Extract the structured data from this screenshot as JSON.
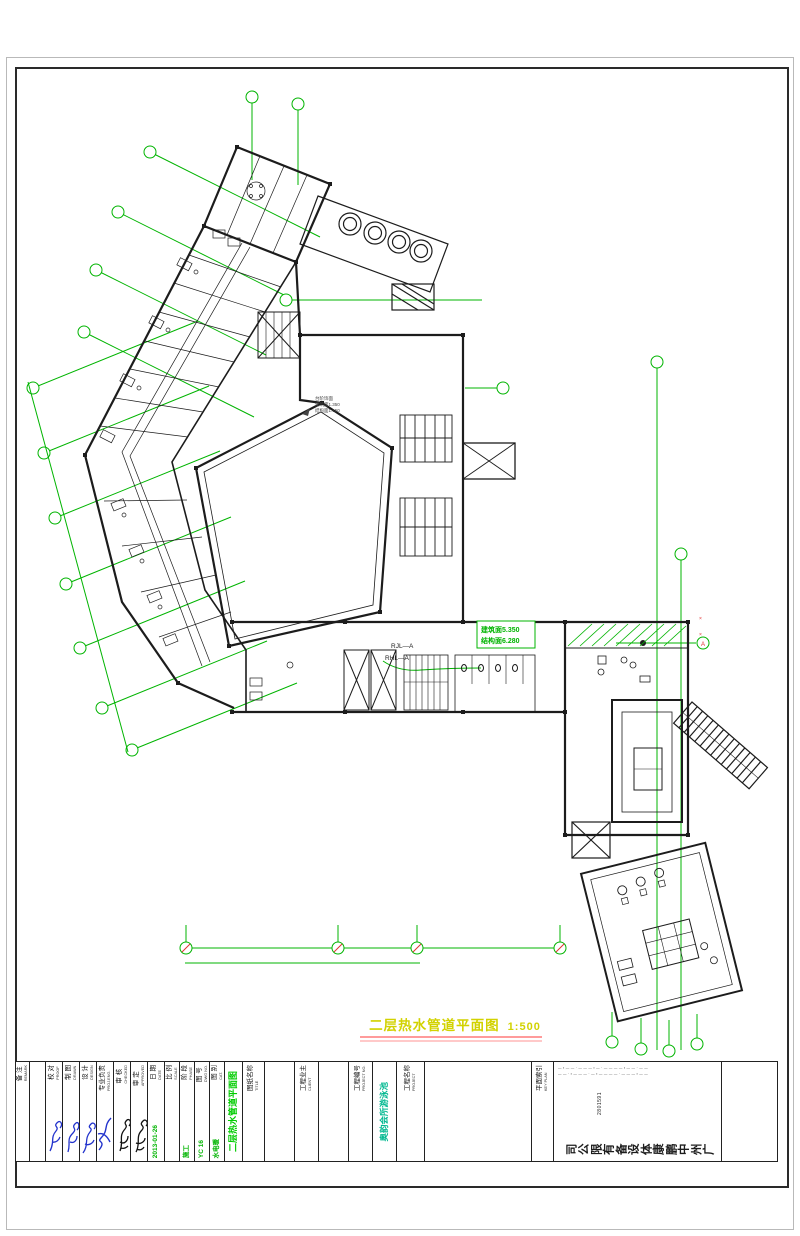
{
  "sheet": {
    "plan_title": "二层热水管道平面图",
    "plan_scale": "1:500"
  },
  "plan": {
    "riser1": "RJL—A",
    "riser2": "RHL—A",
    "elev_line1": "建筑面5.350",
    "elev_line2": "结构面6.280",
    "note1": "台阶饰面",
    "note2": "建筑面1.350",
    "note3": "结构面1.150",
    "axis_bubble_label": "A",
    "red_mark": "×"
  },
  "title_block": {
    "remark": {
      "cn": "备 注",
      "en": "REMARK"
    },
    "proof": {
      "cn": "校 对",
      "en": "PROOF"
    },
    "drawn": {
      "cn": "制 图",
      "en": "DRAWN"
    },
    "design": {
      "cn": "设 计",
      "en": "DESIGN"
    },
    "proj_eng": {
      "cn": "专业负责",
      "en": "PROJ.ENG."
    },
    "checked": {
      "cn": "审 核",
      "en": "CHECKED"
    },
    "approved": {
      "cn": "审 定",
      "en": "APPROVED"
    },
    "date": {
      "cn": "日 期",
      "en": "DATE",
      "value": "2013-01-26"
    },
    "scale": {
      "cn": "比 例",
      "en": "SCALE",
      "value": ""
    },
    "phase": {
      "cn": "阶 段",
      "en": "PHASE",
      "value": "施工"
    },
    "dwg_no": {
      "cn": "图 号",
      "en": "DWG NO.",
      "value": "YC 16"
    },
    "category": {
      "cn": "图 别",
      "en": "CAT.",
      "value": "水电暖"
    },
    "drawing_title_green": "二层热水管道平面图",
    "title_label": {
      "cn": "图纸名称",
      "en": "TITLE"
    },
    "client_label": {
      "cn": "工程业主",
      "en": "CLIENT"
    },
    "project_no_label": {
      "cn": "工程编号",
      "en": "PROJECT NO."
    },
    "project_label": {
      "cn": "工程名称",
      "en": "PROJECT"
    },
    "project_name_green": "奥韵会所游泳池",
    "key_plan_label": {
      "cn": "平面索引",
      "en": "KEY PLAN"
    },
    "company": {
      "name": "广州中鹏康体设备有限公司",
      "digits": "2801591",
      "micro_row1": "—▪——·———▪—·————▪——·——",
      "micro_row2": "——·▪———·—▪————·———▪——"
    }
  }
}
